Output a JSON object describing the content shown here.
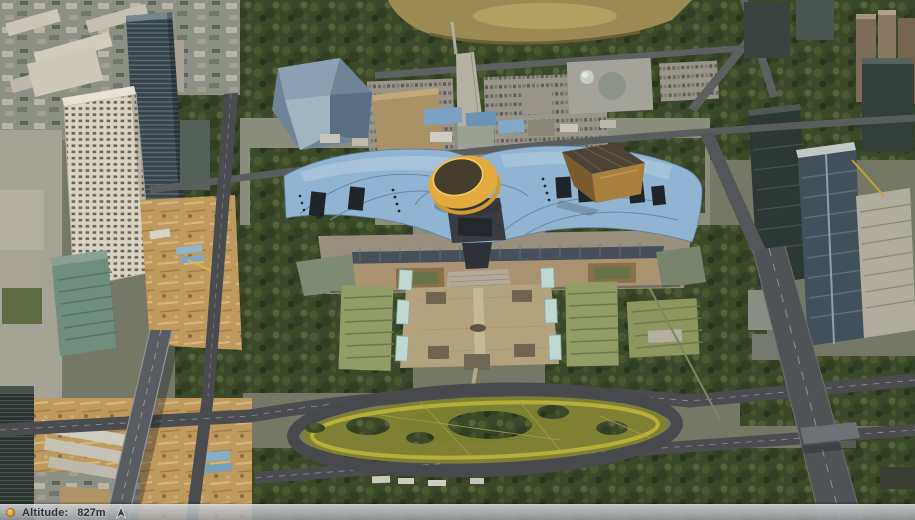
{
  "status_bar": {
    "marker_icon": "orange-dot-icon",
    "altitude_label": "Altitude:",
    "altitude_value": "827m",
    "north_icon": "north-arrow-icon",
    "bar_tint": "rgba(172,176,180,0.85)",
    "text_color": "#2e3237"
  },
  "scene": {
    "description": "oblique 3D aerial city view: wave-roofed civic center with yellow crown cylinder and gold pyramid, central plaza, oval lawn, park hill, skyscrapers left and right, highways",
    "colors": {
      "roof_blue": "#92b4d3",
      "crown_yellow": "#e3aa3d",
      "pyramid_gold": "#a8803e",
      "plaza_tan": "#b3a27e",
      "lawn_olive": "#7e8134",
      "lawn_ring_yellow": "#c2b63c",
      "park_hill": "#9c8a52",
      "tree_green": "#3c4929",
      "road_gray": "#4a4c4f",
      "dirt_tan": "#bf9a5f",
      "tower_white": "#d9d3c4",
      "tower_dark_glass": "#38444a"
    }
  }
}
